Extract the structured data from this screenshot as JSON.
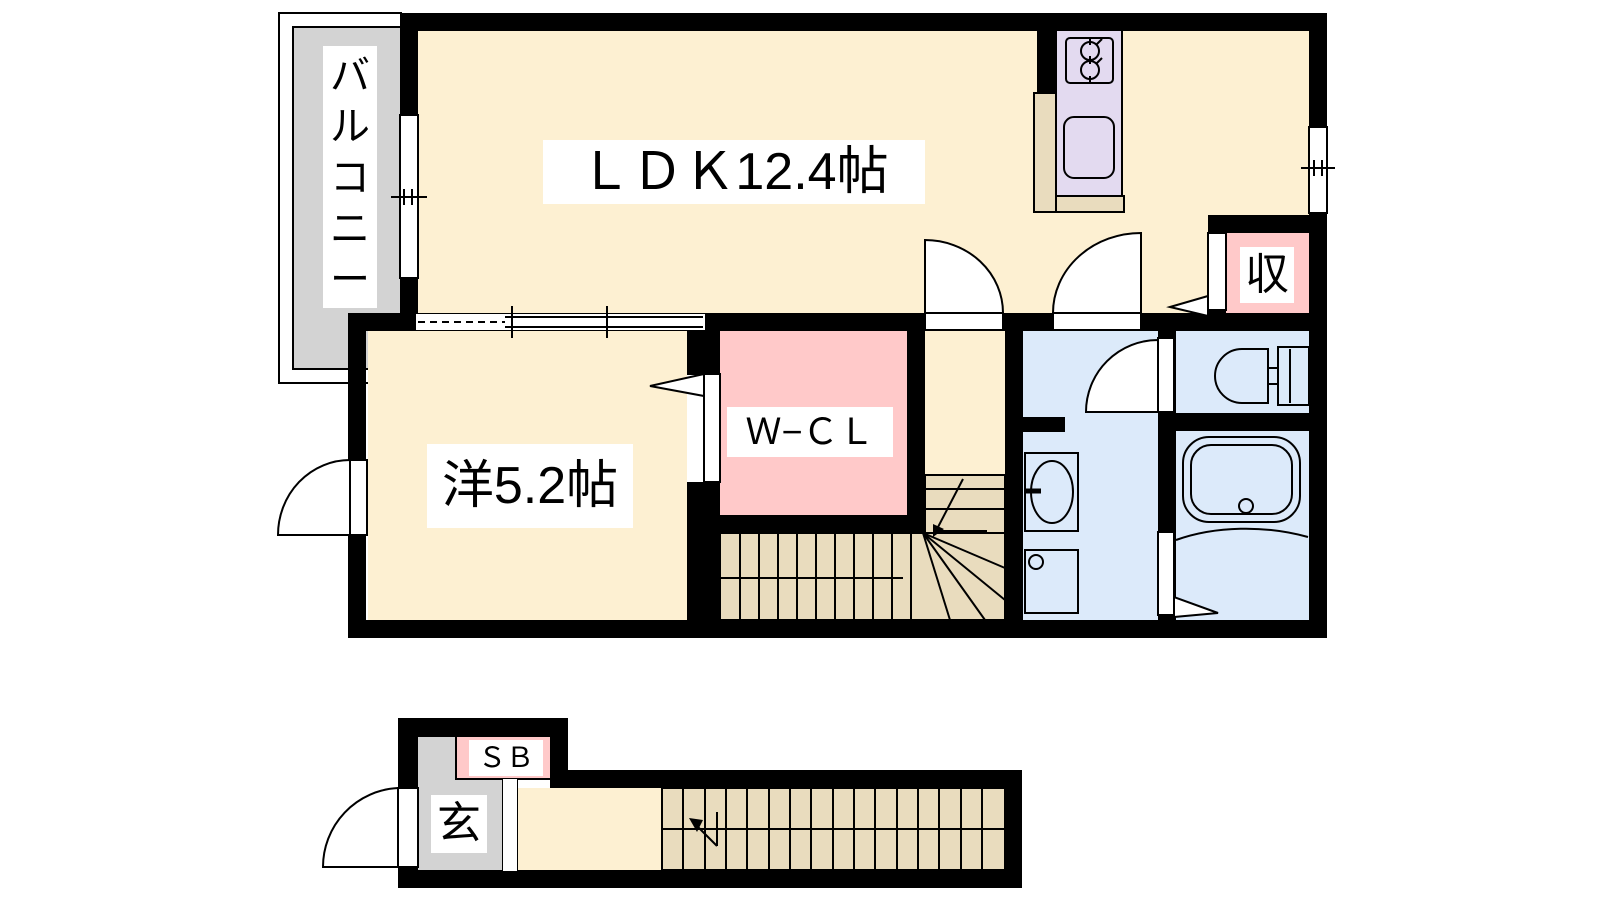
{
  "floorplan": {
    "title": "2F/1F apartment floor plan",
    "rooms": {
      "balcony": {
        "label": "バルコニー"
      },
      "ldk": {
        "label": "ＬＤＫ12.4帖"
      },
      "western_room": {
        "label": "洋5.2帖"
      },
      "walk_in_closet": {
        "label": "Ｗ−ＣＬ"
      },
      "storage": {
        "label": "収"
      },
      "shoe_box": {
        "label": "ＳＢ"
      },
      "entrance": {
        "label": "玄"
      }
    },
    "colors": {
      "room_cream": "#fdf0d2",
      "balcony_gray": "#d3d3d3",
      "closet_pink": "#ffc9c9",
      "wet_area_blue": "#dceafa",
      "kitchen_lavender": "#e3daf0",
      "stairs_beige": "#e9dcbe",
      "wall_black": "#000000",
      "bg_white": "#ffffff"
    }
  }
}
